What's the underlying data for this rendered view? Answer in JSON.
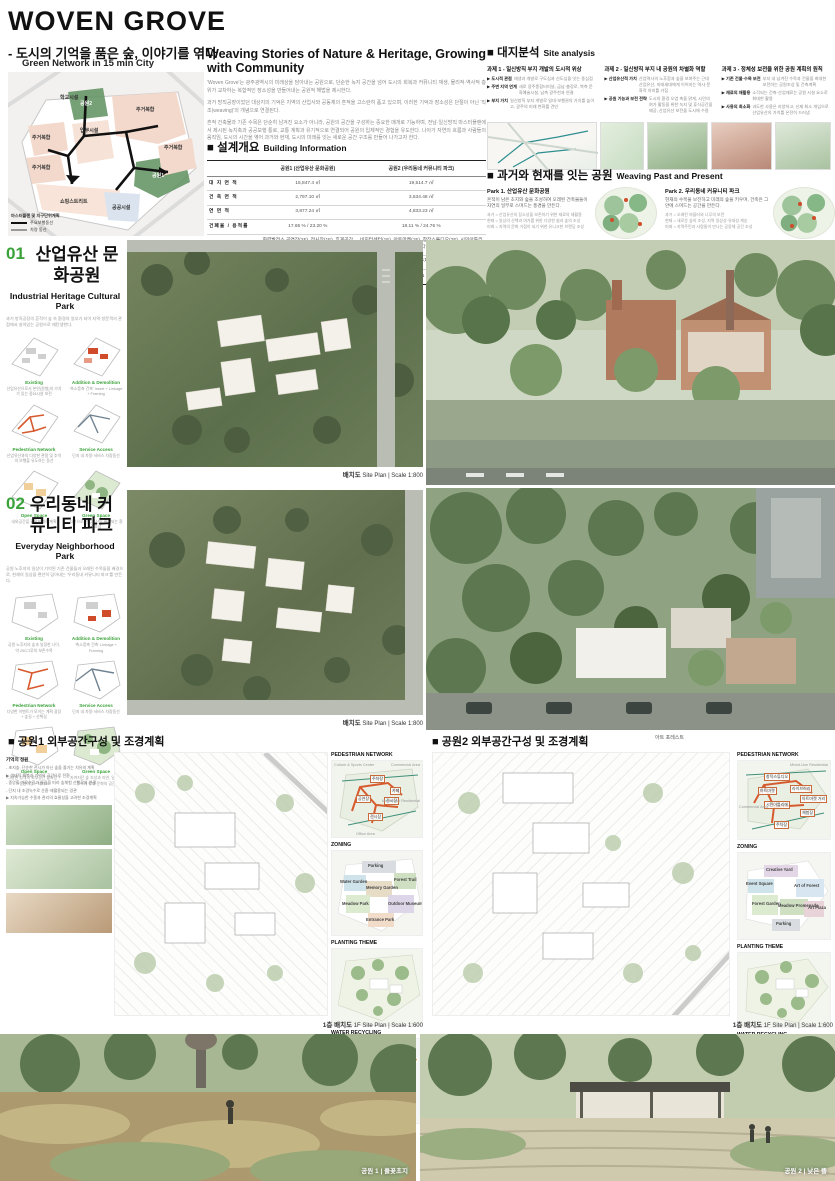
{
  "colors": {
    "accent_green": "#3aa23a",
    "route_orange": "#e0502a",
    "diagram_teal": "#2f8f8f",
    "block_pink": "#f3d9cc",
    "park_green": "#7fae80"
  },
  "header": {
    "title": "WOVEN GROVE",
    "subtitle": "- 도시의 기억을 품은 숲, 이야기를 엮다",
    "map_caption": "Green Network in 15 min City",
    "map_labels": [
      "학교시설",
      "업무시설",
      "주거복합",
      "주거복합",
      "주거복합",
      "주거복합",
      "쇼핑스트리트",
      "공공시설",
      "공원1",
      "공원2"
    ],
    "legend": {
      "title": "마스터플랜 및 지구단위계획",
      "items": [
        "주요보행동선",
        "차량 동선"
      ]
    }
  },
  "intro": {
    "heading": "Weaving Stories of Nature & Heritage, Growing with Community",
    "p1": "'Woven Grove'는 광주광역시의 미래상을 담아내는 공원으로, 단순한 녹지 공간을 넘어 도시의 회복과 커뮤니티 재생, 물리적·역사적 층위가 교차하는 복합적인 장소성을 만들어내는 공원적 해법을 제시한다.",
    "p2": "과거 방직공장이었던 대상지의 기억은 지역의 산업사와 공동체의 흔적을 고스란히 품고 있으며, 이러한 기억과 장소성은 단절이 아닌 '직조(weaving)'의 개념으로 연결된다.",
    "p3": "흔적 건축물과 기존 수목은 단순히 남겨진 요소가 아니라, 공원의 공간을 구성하는 중요한 매개로 기능하며, 전남·일신방직 마스터플랜에서 제시된 녹지축과 공공보행 통로, 교통 계획과 유기적으로 연결되어 공원의 입체적인 경험을 유도한다. 나아가 자연의 흐름과 사람들의 움직임, 도시의 시간을 엮어 과거와 현재, 도시의 미래를 잇는 새로운 공간 구조를 만들어 나가고자 한다."
  },
  "building_info": {
    "heading_ko": "■ 설계개요",
    "heading_en": "Building Information",
    "col1": "공원1 (산업유산 문화공원)",
    "col2": "공원2 (우리동네 커뮤니티 파크)",
    "rows": [
      {
        "label": "대 지 면 적",
        "v1": "15,847.4 ㎡",
        "v2": "19,514.7 ㎡"
      },
      {
        "label": "건 축 면 적",
        "v1": "2,797.10 ㎡",
        "v2": "3,534.48 ㎡"
      },
      {
        "label": "연   면   적",
        "v1": "3,877.24 ㎡",
        "v2": "4,833.23 ㎡"
      },
      {
        "label": "건폐율 / 용적률",
        "v1": "17.65 % / 23.20 %",
        "v2": "18.11 % / 24.76 %"
      },
      {
        "label": "프로그램 ( 층수 )",
        "v1": "화력발전소 공연장(2F), 전시장(1F), 휴게공간(1F), 전시 플러스터(2F), 직조공장 카페(1F)",
        "v2": "비지터센터(1F), 아트마켓(1F), 창작스튜디오(2F), 시민아틀리에(1F), 라이브러리(2F), 카페&다이닝(2F), 카페 키오스크(1F)"
      },
      {
        "label": "주 차 대 수",
        "v1": "45대 (장애인주차 2대 포함)",
        "v2": "59대 (장애인주차 2대 포함)"
      },
      {
        "label": "생태면적률",
        "v1": "51.38 %",
        "v2": "50.41 %"
      }
    ]
  },
  "site_analysis": {
    "heading_ko": "■ 대지분석",
    "heading_en": "Site analysis",
    "tasks": [
      {
        "title": "과제 1 - 일신방직 부지 개발의 도시적 위상",
        "b": [
          {
            "k": "▶ 도시적 관점",
            "t": "재생과 개발로 구도심과 신도심을 잇는 중심점"
          },
          {
            "k": "▶ 주변 지역 연계",
            "t": "새로 광주종합터미널, 금남·충장로, 북측 문화예술시설, 남측 광주천과 연결"
          },
          {
            "k": "▶ 부지 가치",
            "t": "일신방직 부지 개발로 일대·보행권의 가치를 높이고, 광주의 미래 변화를 견인"
          }
        ]
      },
      {
        "title": "과제 2 - 일신방직 부지 내 공원의 차별화 역할",
        "b": [
          {
            "k": "▶ 산업유산적 가치",
            "t": "산업역사의 노후함과 숲을 보여주는 근대 산업유산, 미래세대에게 이어지는 역사·문화적 의미를 가짐"
          },
          {
            "k": "▶ 공원 기능과 보전 전략",
            "t": "도시의 환경 오염 축을 맑게, 시민의 여가 활동을 위한 녹지 및 휴식공간을 제공, 산업유산 보전을 도시에 수용"
          }
        ]
      },
      {
        "title": "과제 3 - 정체성 보전을 위한 공원 계획의 원칙",
        "b": [
          {
            "k": "▶ 기존 건물·수목 보전",
            "t": "부지 내 남겨진 수목과 건물을 최대한 보전하는 공원조성 및 건축계획"
          },
          {
            "k": "▶ 재료의 재활용",
            "t": "소각되는 건축·산업재료는 공원 시설 요소로 최대한 활용"
          },
          {
            "k": "▶ 사용의 최소화",
            "t": "과도한 사용은 지양하고, 신재 최소 개입으로 산업유산의 가치를 온전히 드러냄"
          }
        ]
      }
    ]
  },
  "weaving": {
    "heading_ko": "■ 과거와 현재를 잇는 공원",
    "heading_en": "Weaving Past and Present",
    "park1": {
      "title": "Park 1. 산업유산 문화공원",
      "desc": "흔적이 남은 초지와 숲을 조성하여 오래된 건축물들이 자연의 일부로 스며드는 풍경을 만든다.",
      "b1": "과거 = 산업유산의 장소성을 보존하기 위한 재료의 재활용",
      "b2": "현재 = 일상의 산책과 여가를 위한 다양한 쉼과 숲의 조성",
      "b3": "미래 = 지역의 문화 거점이 되기 위한 유니크한 브랜딩 조성"
    },
    "park2": {
      "title": "Park 2. 우리동네 커뮤니티 파크",
      "desc": "현재의 수목을 보전하고 미래의 숲을 키우며, 건축은 그 안에 스며드는 공간을 만든다.",
      "b1": "과거 = 오래된 마을터와 나무의 보전",
      "b2": "현재 = 새로운 숲의 조성, 지역 일상성·유대성 계승",
      "b3": "미래 = 지역주민과 사람들이 만나는 공동체 공간 조성"
    }
  },
  "section01": {
    "number": "01",
    "title_ko": "산업유산 문화공원",
    "title_en": "Industrial Heritage Cultural Park",
    "desc": "과거 방직공장의 흔적이 숲 속 환경의 일부가 되어 지역·방문객의 관점에서 살아있는 공원으로 재탄생한다.",
    "diagrams": [
      {
        "label": "Existing",
        "caption": "산업유산으로서 본연(원형)의 가치가 있는 중요시설 보전"
      },
      {
        "label": "Addition & Demolition",
        "caption": "'축소증축 건축' Insert + Linkage + Framing"
      },
      {
        "label": "Pedestrian Network",
        "caption": "산업유산과의 다양한 관람 및 추억의 보행을 유도하는 동선"
      },
      {
        "label": "Service Access",
        "caption": "단지 내 차량·서비스 차량동선"
      },
      {
        "label": "Open Space",
        "caption": "내외공간을 활용한 마당계획"
      },
      {
        "label": "Green Space",
        "caption": "자연으로 산업유산이 확장되는 환경조성"
      }
    ],
    "plan_caption_ko": "배치도",
    "plan_caption_en": "Site Plan  |  Scale 1:800"
  },
  "section02": {
    "number": "02",
    "title_ko": "우리동네 커뮤니티 파크",
    "title_en": "Everyday Neighborhood Park",
    "desc": "공원 노후지의 일상이 기억된 기존 건물들과 오래된 수목들을 배경으로, 현재의 일상을 편안히 담아내는 '우리동네 커뮤니티 파크'를 만든다.",
    "diagrams": [
      {
        "label": "Existing",
        "caption": "공원 노후지의 숲과 일정한 나이, 약 250그루의 보존수목"
      },
      {
        "label": "Addition & Demolition",
        "caption": "'축소증축 건축' Linkage + Framing"
      },
      {
        "label": "Pedestrian Network",
        "caption": "다양한 이벤트가 모이는 계획 광장 + 숲길 + 산책길"
      },
      {
        "label": "Service Access",
        "caption": "단지 내 차량·서비스 차량동선"
      },
      {
        "label": "Open Space",
        "caption": "다양한 성격의 외부공간 앞마당 + 정원마당 + 테라스"
      },
      {
        "label": "Green Space",
        "caption": "지켜지던 숲 조성과 자연, 일상적 휴식과 유대·문화의 공간"
      }
    ],
    "plan_caption_ko": "배치도",
    "plan_caption_en": "Site Plan  |  Scale 1:800"
  },
  "landscape1": {
    "heading": "■ 공원1 외부공간구성 및 조경계획",
    "notes_title": "기억의 정원",
    "notes": [
      "- 초지숲: 단순한 전시가 아닌 숲을 즐기는 치유의 계획",
      "▶ 생태적 회복과 기억의 공간으로 전환",
      "- 중앙홀 가로수길과 물길을 따라 숲체험 산책로의 연결",
      "- 단지 내 조경녹수로 순환·재활용되는 경관",
      "▶ 지속가능한 수종과 관리의 효율성을 고려한 조경계획"
    ],
    "pednet_title": "PEDESTRIAN NETWORK",
    "pednet_labels": [
      "주차장",
      "카페",
      "공연장",
      "전시장",
      "전시장"
    ],
    "pednet_context": [
      "Culture & Sports Center",
      "Commercial Area",
      "Mixed-Use Residential",
      "Office Area"
    ],
    "zoning_title": "ZONING",
    "zones": [
      "Parking",
      "Water Garden",
      "Forest Trail",
      "Memory Garden",
      "Meadow Park",
      "Outdoor Museum",
      "Entrance Park"
    ],
    "planting_title": "PLANTING THEME",
    "water_title": "WATER RECYCLING",
    "water_nodes": [
      "Retention Pond",
      "Heritage",
      "Park"
    ],
    "plan_caption_ko": "1층 배치도",
    "plan_caption_en": "1F Site Plan  |  Scale 1:600"
  },
  "landscape2": {
    "heading": "■ 공원2 외부공간구성 및 조경계획",
    "plan_note": "아트 포레스트",
    "pednet_title": "PEDESTRIAN NETWORK",
    "pednet_labels": [
      "창작스튜디오",
      "아트마켓",
      "라이브러리",
      "시민아틀리에",
      "아트마켓 거리",
      "체험장",
      "주차장"
    ],
    "pednet_context": [
      "Mixed-Use Residential",
      "Commercial Area"
    ],
    "zoning_title": "ZONING",
    "zones": [
      "Creative Yard",
      "Event Square",
      "Art of Forest",
      "Forest Garden",
      "Meadow Promenade",
      "Art Plaza",
      "Parking"
    ],
    "planting_title": "PLANTING THEME",
    "water_title": "WATER RECYCLING",
    "water_nodes": [
      "Retention Pond",
      "Garden & Forest",
      "Rainwater"
    ],
    "plan_caption_ko": "1층 배치도",
    "plan_caption_en": "1F Site Plan  |  Scale 1:600"
  },
  "footer": {
    "park1_caption": "공원 1  |  풀꽃초지",
    "park2_caption": "공원 2  |  낮은 뜰"
  }
}
